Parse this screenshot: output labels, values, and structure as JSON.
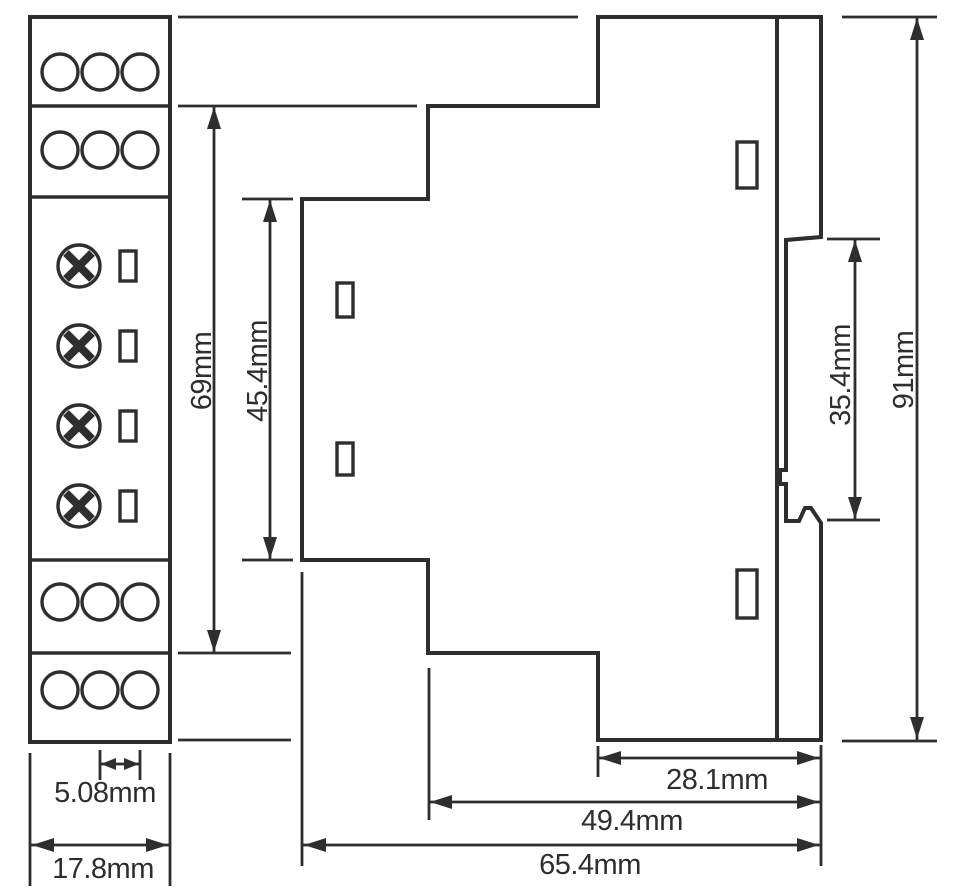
{
  "drawing": {
    "type": "technical dimension drawing",
    "subject": "DIN-rail module, front view and side view",
    "background_color": "#ffffff",
    "line_color": "#2d2e30",
    "front_view": {
      "terminal_rows_top": 2,
      "terminal_rows_bottom": 2,
      "terminals_per_row": 3,
      "screw_symbols": 4,
      "led_slots": 4
    },
    "side_view": {
      "front_slots": 2,
      "back_slots": 2,
      "din_rail_clip": true
    },
    "dimensions": {
      "terminal_pitch": "5.08mm",
      "front_width": "17.8mm",
      "body_height": "69mm",
      "face_height": "45.4mm",
      "rail_slot_height": "35.4mm",
      "total_height": "91mm",
      "rail_to_back_depth": "28.1mm",
      "mid_step_depth": "49.4mm",
      "total_depth": "65.4mm"
    }
  }
}
